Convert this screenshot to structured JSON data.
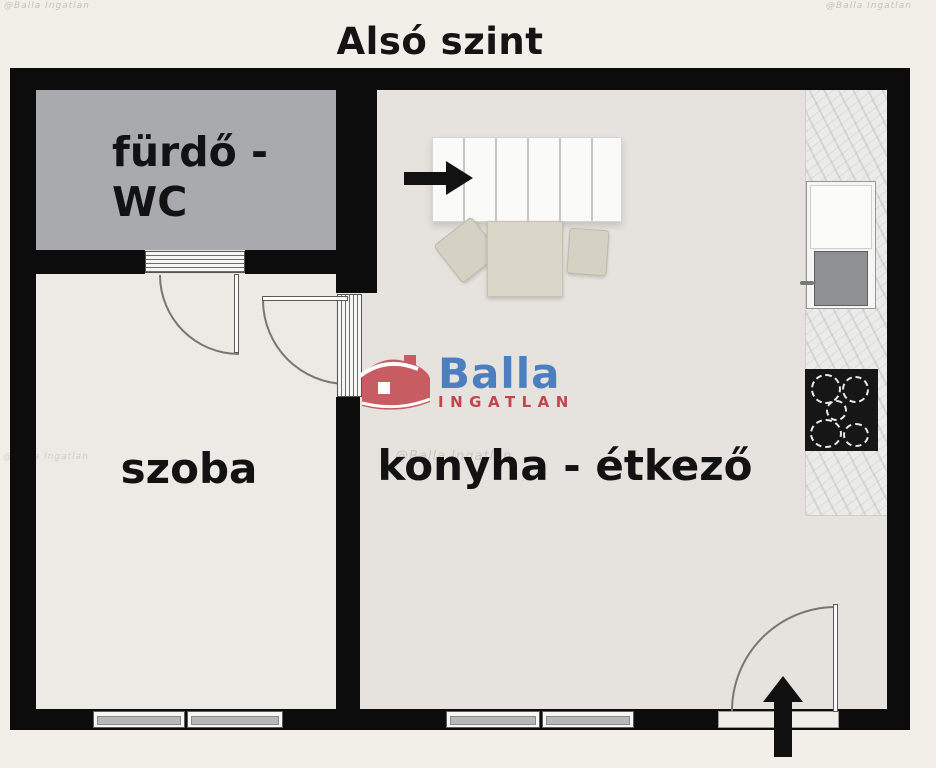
{
  "title": "Alsó szint",
  "rooms": {
    "bathroom_line1": "fürdő -",
    "bathroom_line2": "WC",
    "room": "szoba",
    "kitchen": "konyha - étkező"
  },
  "logo": {
    "brand": "Balla",
    "subtitle": "INGATLAN"
  },
  "watermark": "@Balla Ingatlan",
  "icons": {
    "stairs_arrow": "arrow-right",
    "entrance_arrow": "arrow-up",
    "logo_house": "house-icon"
  },
  "colors": {
    "background": "#f2efe9",
    "wall": "#0c0c0c",
    "bathroom_floor": "#a8aaae",
    "room_floor": "#eceae4",
    "kitchen_floor": "#e6e3de",
    "furniture": "#d9d6c8",
    "logo_blue": "#4d7fc0",
    "logo_red": "#c4454f"
  }
}
